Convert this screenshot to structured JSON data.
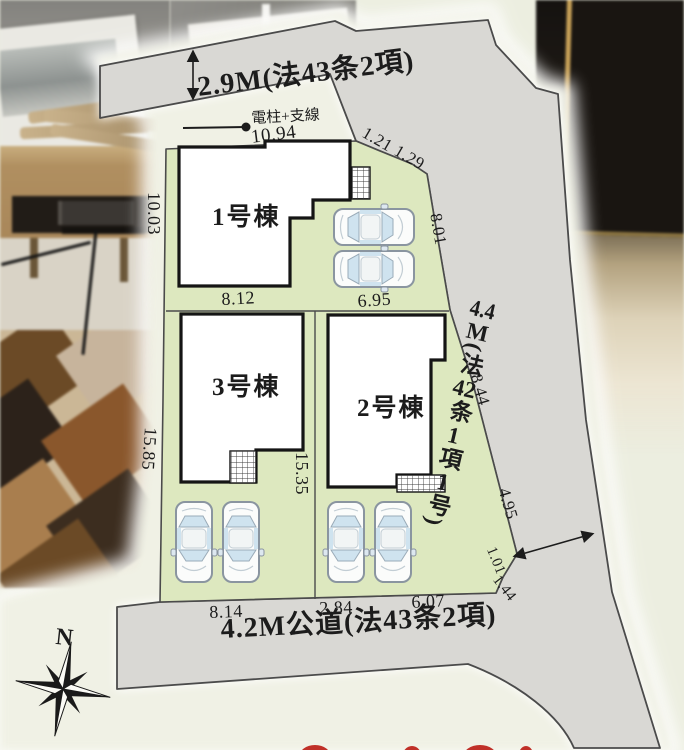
{
  "plan": {
    "roads": {
      "top": {
        "label": "2.9M(法43条2項)"
      },
      "bottom": {
        "label": "4.2M公道(法43条2項)"
      },
      "right": {
        "p1": "4.4",
        "p2": "M",
        "p3": "(法",
        "p4": "42",
        "p5": "条",
        "p6": "1",
        "p7": "項",
        "p8": "1",
        "p9": "号)"
      }
    },
    "pole_label": "電柱+支線",
    "buildings": {
      "b1": "1号棟",
      "b2": "2号棟",
      "b3": "3号棟"
    },
    "dimensions": {
      "top": "10.94",
      "left_upper": "10.03",
      "b1_bottom": "8.12",
      "b1_right": "6.95",
      "chamfer_a": "1.21",
      "chamfer_b": "1.29",
      "right_upper": "8.01",
      "right_mid": "8.44",
      "right_lower": "4.95",
      "corner_a": "1.01",
      "corner_b": "1.44",
      "left_lower": "15.85",
      "center": "15.35",
      "bottom_left": "8.14",
      "bottom_mid": "2.84",
      "bottom_right": "6.07"
    },
    "compass": {
      "north": "N"
    },
    "colors": {
      "lot_green": "#dde8bf",
      "road_gray": "#d9d8d4",
      "paper_cream": "#f0f1e5",
      "red_accent": "#c03028"
    }
  }
}
